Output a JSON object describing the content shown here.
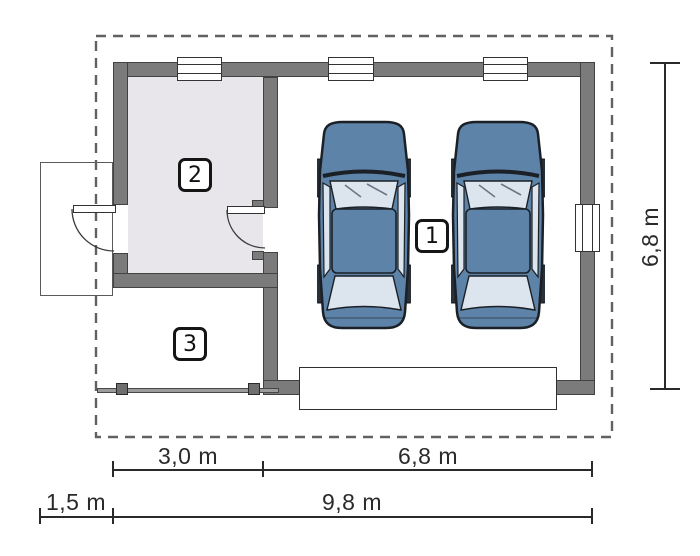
{
  "rooms": [
    {
      "number": "1"
    },
    {
      "number": "2"
    },
    {
      "number": "3"
    }
  ],
  "dimensions": {
    "segments_row": [
      {
        "label": "3,0 m"
      },
      {
        "label": "6,8 m"
      }
    ],
    "overall_row": [
      {
        "label": "1,5 m"
      },
      {
        "label": "9,8 m"
      }
    ],
    "right_vertical": {
      "label": "6,8 m"
    }
  },
  "colors": {
    "wall": "#7b7b7b",
    "wall_outline": "#424242",
    "room2_floor": "#e8e5eb",
    "boundary": "#616161",
    "dimension": "#2a2a2a",
    "symbol_outline": "#333333",
    "fence": "#9b9b9b",
    "car_body": "#5d83a8",
    "car_glass": "#dce4ee",
    "car_outline": "#1b2026",
    "wheel": "#2a3038"
  }
}
